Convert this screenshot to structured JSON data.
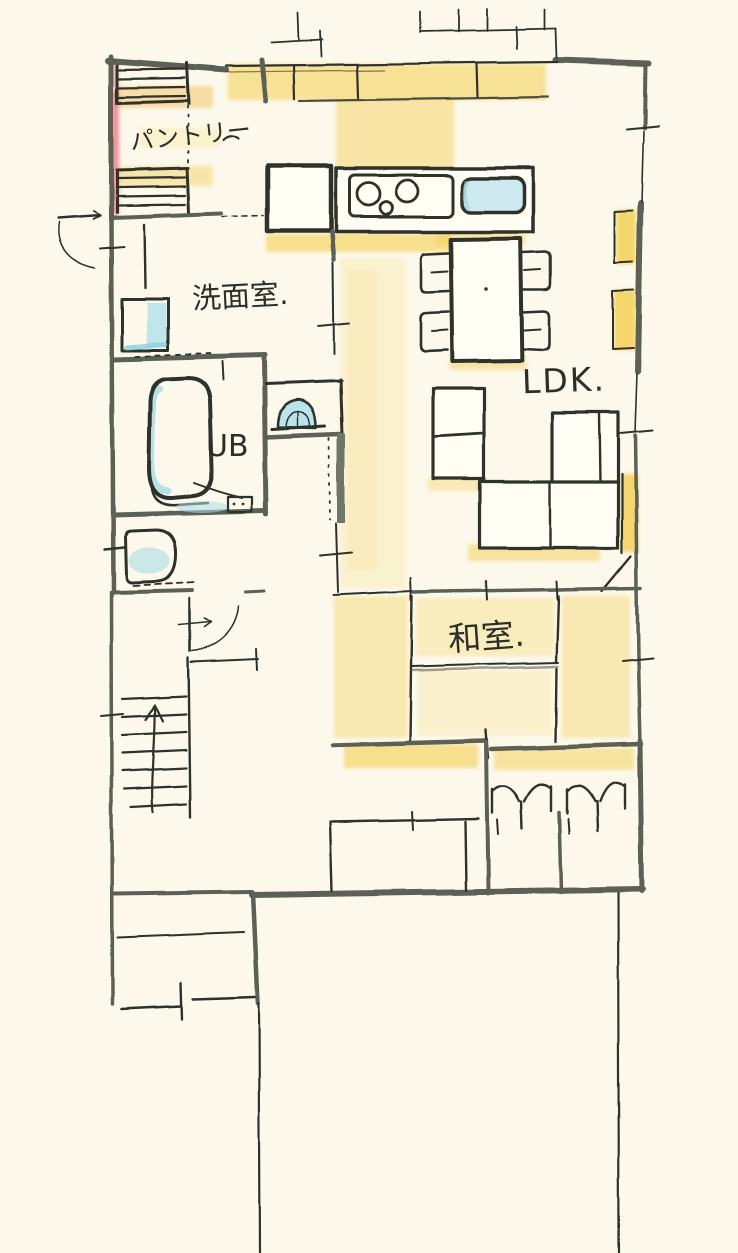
{
  "drawing": {
    "kind": "hand-drawn floor plan sketch",
    "floor": "1F layout"
  },
  "rooms": {
    "pantry": {
      "label": "パントリー"
    },
    "washroom": {
      "label": "洗面室."
    },
    "unit_bath": {
      "label": "UB"
    },
    "ldk": {
      "label": "LDK."
    },
    "japanese_room": {
      "label": "和室."
    }
  },
  "fixtures": [
    "pantry-shelves",
    "kitchen-counter",
    "island-counter",
    "gas-stove",
    "kitchen-sink",
    "refrigerator",
    "dining-table",
    "dining-chairs",
    "tv-board",
    "sofa",
    "wall-cabinets",
    "vanity-basin",
    "washbasin-counter",
    "bathtub",
    "toilet",
    "staircase-up-arrow",
    "closet-folding-doors",
    "swing-door",
    "entrance-door",
    "windows",
    "tatami-divider"
  ],
  "palette": {
    "paper": "#fcf9ec",
    "ink": "#2f312b",
    "wall_gray": "#5b6054",
    "highlight_yellow": "#f3cd4e",
    "water_blue": "#a9dce6",
    "accent_red": "#e8506b"
  }
}
